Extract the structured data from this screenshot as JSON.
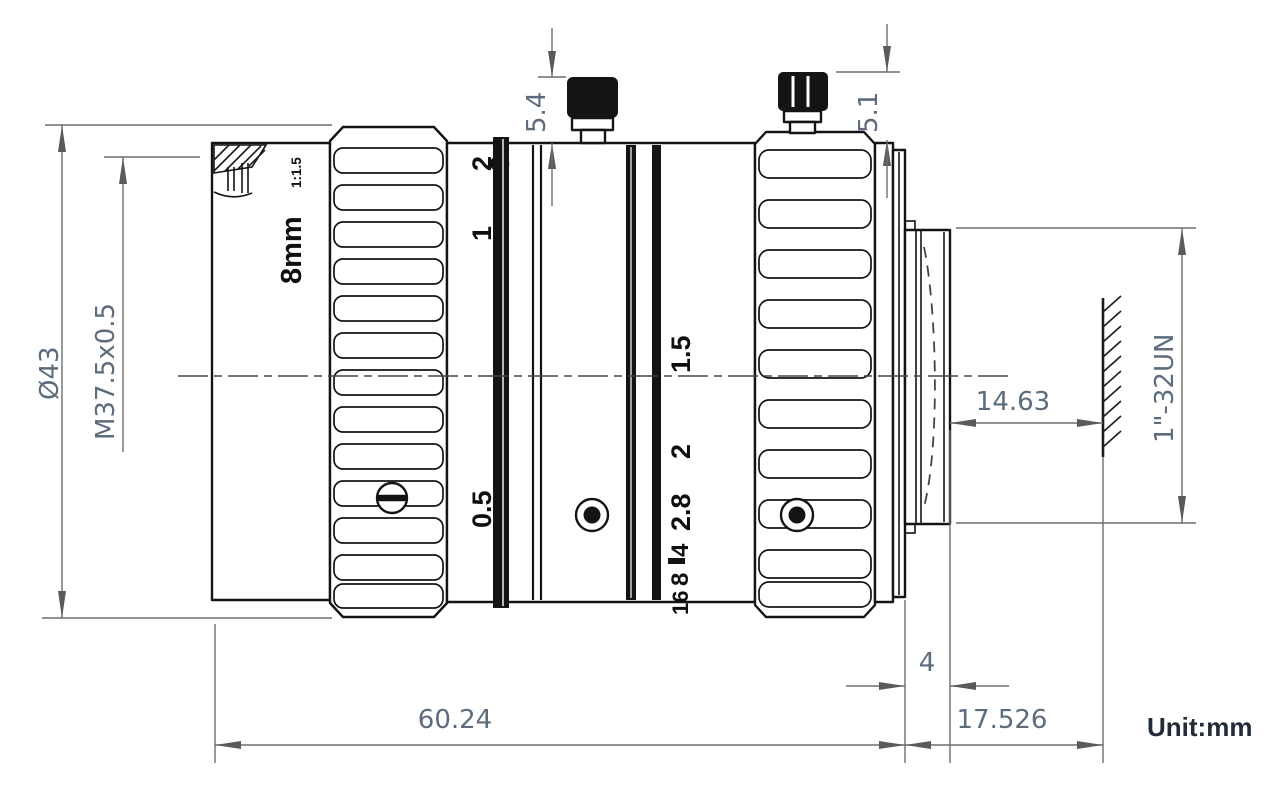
{
  "unit_label": "Unit:mm",
  "dimensions": {
    "outer_diameter": "Ø43",
    "filter_thread": "M37.5x0.5",
    "front_screw_height": "5.4",
    "rear_screw_height": "5.1",
    "mount_thread": "1\"-32UN",
    "flange_focal_distance": "14.63",
    "mount_thread_length": "4",
    "body_length": "60.24",
    "rear_length": "17.526"
  },
  "markings": {
    "focal_length": "8mm",
    "aperture_ratio": "1:1.5",
    "focus_scale": [
      "2",
      "1",
      "0.5"
    ],
    "focus_scale_partial": "3",
    "aperture_scale": [
      "1.5",
      "2",
      "2.8",
      "4",
      "8",
      "16"
    ]
  },
  "colors": {
    "drawing_line": "#141414",
    "dimension_line": "#6e6e6e",
    "dimension_text": "#5d6c7c",
    "unit_text": "#222b38"
  }
}
